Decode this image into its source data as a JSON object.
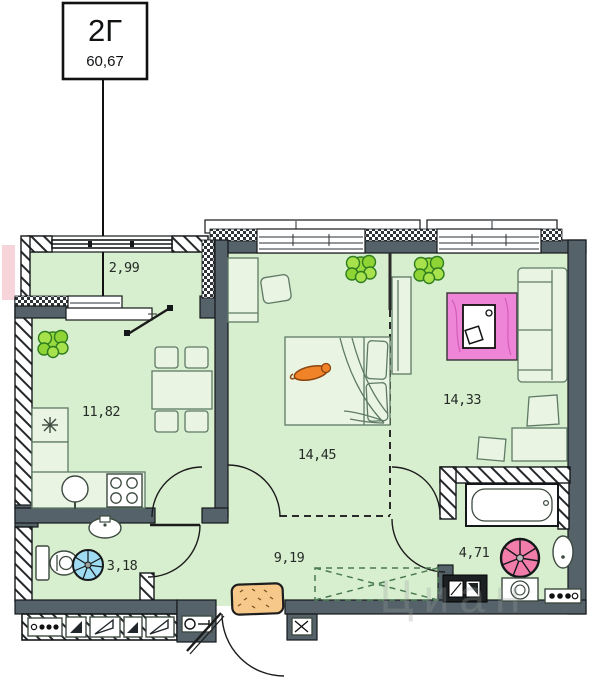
{
  "page": {
    "title_box": {
      "unit": "2Г",
      "area": "60,67"
    },
    "watermark": "Циан",
    "rooms": [
      {
        "id": "balcony",
        "area": "2,99"
      },
      {
        "id": "kitchen",
        "area": "11,82"
      },
      {
        "id": "bedroom",
        "area": "14,45"
      },
      {
        "id": "living-room",
        "area": "14,33"
      },
      {
        "id": "wc",
        "area": "3,18"
      },
      {
        "id": "hallway",
        "area": "9,19"
      },
      {
        "id": "bathroom",
        "area": "4,71"
      }
    ],
    "colors": {
      "floor": "#d8efcf",
      "wall": "#556269",
      "rug_pink": "#ee85d6",
      "fan_blue": "#9fdcf2",
      "fan_pink": "#f27daa",
      "plant_green": "#98d93e",
      "doormat": "#f6c98b",
      "cat_orange": "#f08228",
      "neighbor_pink": "#f7d3da"
    },
    "icons": [
      "bed",
      "cat",
      "sofa",
      "rug",
      "coffee-table",
      "wardrobe",
      "desk",
      "chair",
      "dining-table",
      "stove",
      "kitchen-sink",
      "toilet",
      "washbasin",
      "bathtub",
      "washing-machine",
      "fan",
      "plant",
      "doormat",
      "electric-panel"
    ]
  }
}
